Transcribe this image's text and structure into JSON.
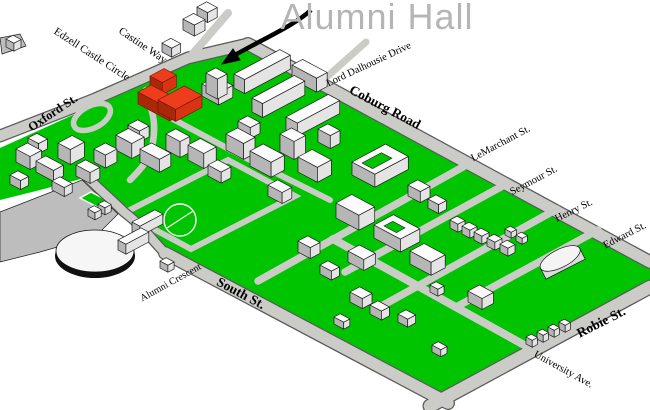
{
  "title": {
    "text": "Alumni Hall"
  },
  "map": {
    "highlighted_building": "Alumni Hall",
    "colors": {
      "background": "#ffffff",
      "grass": "#00c400",
      "road": "#cbcbc8",
      "road_edge": "#5a5a5a",
      "parking": "#bdbdbd",
      "building_top": "#fcfcfc",
      "building_side_light": "#e4e4e4",
      "building_side_dark": "#b6b6b6",
      "highlight_top": "#ee3d1c",
      "highlight_side_light": "#d63413",
      "highlight_side_dark": "#a82809",
      "label": "#000000",
      "title": "#b5b5b5"
    },
    "streets": [
      {
        "name": "Edzell Castle  Circle",
        "bold": false
      },
      {
        "name": "Castine Way",
        "bold": false
      },
      {
        "name": "Oxford St.",
        "bold": true
      },
      {
        "name": "Lord Dalhousie Drive",
        "bold": false
      },
      {
        "name": "Coburg Road",
        "bold": true
      },
      {
        "name": "LeMarchant St.",
        "bold": false
      },
      {
        "name": "Seymour St.",
        "bold": false
      },
      {
        "name": "Henry St.",
        "bold": false
      },
      {
        "name": "Edward St.",
        "bold": false
      },
      {
        "name": "Robie St.",
        "bold": true
      },
      {
        "name": "University Ave.",
        "bold": false
      },
      {
        "name": "South St.",
        "bold": true
      },
      {
        "name": "Alumni Crescent",
        "bold": false
      }
    ]
  }
}
